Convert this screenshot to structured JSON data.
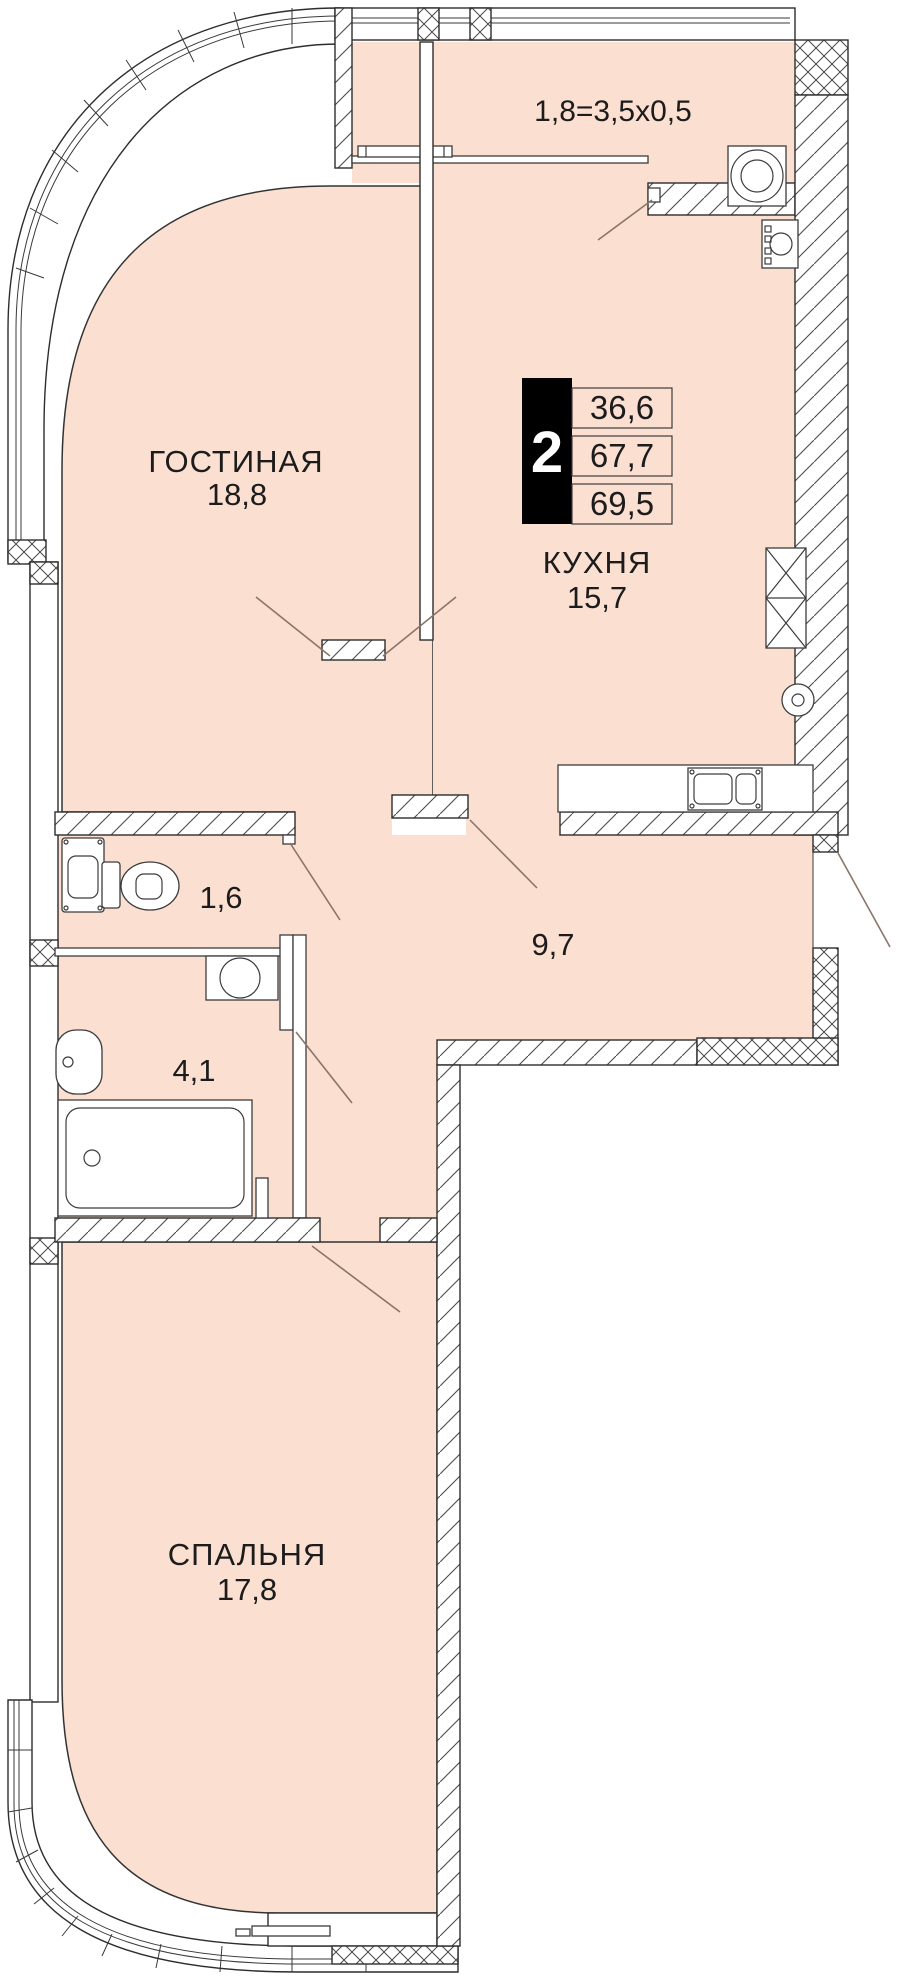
{
  "plan": {
    "colors": {
      "interior": "#fbdfd1",
      "wall_line": "#2d2d2d",
      "badge_bg": "#000000",
      "badge_text": "#ffffff",
      "door_swing": "#8a7568"
    },
    "badge": {
      "rooms_count": "2",
      "areas": [
        "36,6",
        "67,7",
        "69,5"
      ]
    },
    "loggia": {
      "dimension": "1,8=3,5х0,5"
    },
    "rooms": {
      "living": {
        "name": "ГОСТИНАЯ",
        "area": "18,8"
      },
      "kitchen": {
        "name": "КУХНЯ",
        "area": "15,7"
      },
      "bedroom": {
        "name": "СПАЛЬНЯ",
        "area": "17,8"
      },
      "wc": {
        "area": "1,6"
      },
      "hallway": {
        "area": "9,7"
      },
      "bathroom": {
        "area": "4,1"
      }
    }
  }
}
